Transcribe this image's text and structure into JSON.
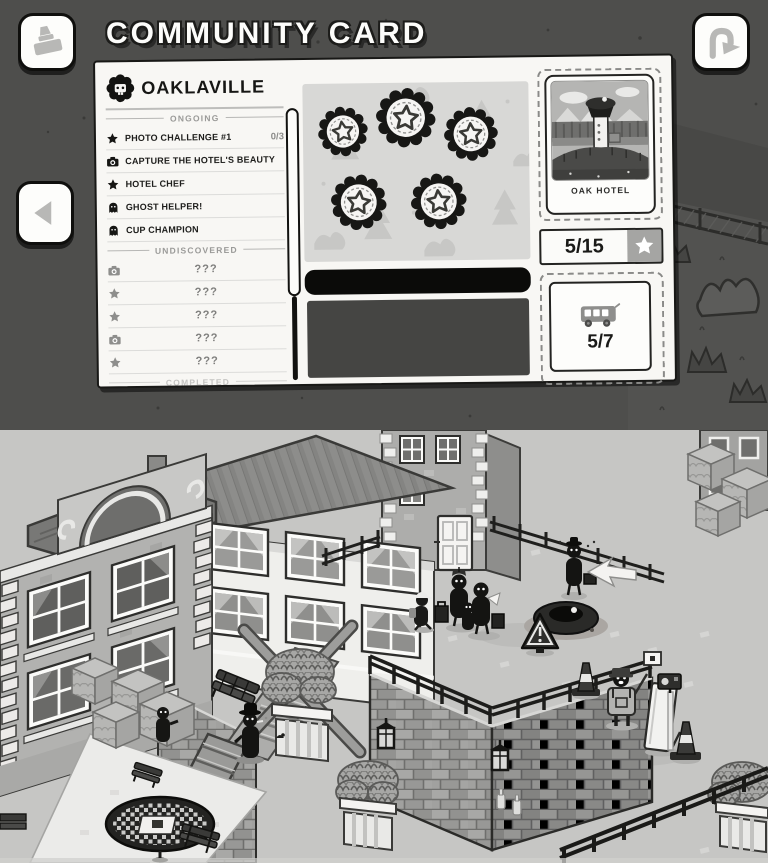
{
  "app": {
    "title": "COMMUNITY CARD"
  },
  "toolbar": {
    "stamp_button_icon": "stamp-icon",
    "flip_button_icon": "curved-arrow-icon",
    "prev_button_icon": "left-triangle-icon"
  },
  "card": {
    "town": "OAKLAVILLE",
    "mascot_icon": "town-mascot-icon",
    "ongoing": {
      "label": "ONGOING",
      "items": [
        {
          "icon": "star",
          "label": "PHOTO CHALLENGE #1",
          "progress": "0/3"
        },
        {
          "icon": "camera",
          "label": "CAPTURE THE HOTEL'S BEAUTY"
        },
        {
          "icon": "star",
          "label": "HOTEL CHEF"
        },
        {
          "icon": "ghost",
          "label": "GHOST HELPER!"
        },
        {
          "icon": "ghost",
          "label": "CUP CHAMPION"
        }
      ]
    },
    "undiscovered": {
      "label": "UNDISCOVERED",
      "items": [
        {
          "icon": "camera",
          "label": "???"
        },
        {
          "icon": "star",
          "label": "???"
        },
        {
          "icon": "star",
          "label": "???"
        },
        {
          "icon": "camera",
          "label": "???"
        },
        {
          "icon": "star",
          "label": "???"
        }
      ]
    },
    "completed": {
      "label": "COMPLETED"
    },
    "stamps": {
      "collected": 5,
      "style": "scalloped-star-stamp"
    },
    "photo": {
      "caption": "OAK HOTEL"
    },
    "star_counter": "5/15",
    "bus_counter": "5/7"
  },
  "colors": {
    "header_bg": "#4e4e4c",
    "card_bg": "#f8f7f4",
    "stamp_panel_bg": "#d8d8d6",
    "black_bar": "#0b0b09",
    "dark_panel": "#454543",
    "badge_gray": "#a5a5a3",
    "ink": "#161614",
    "muted": "#8e8e8c",
    "scene_ground": "#c6c6c4"
  }
}
